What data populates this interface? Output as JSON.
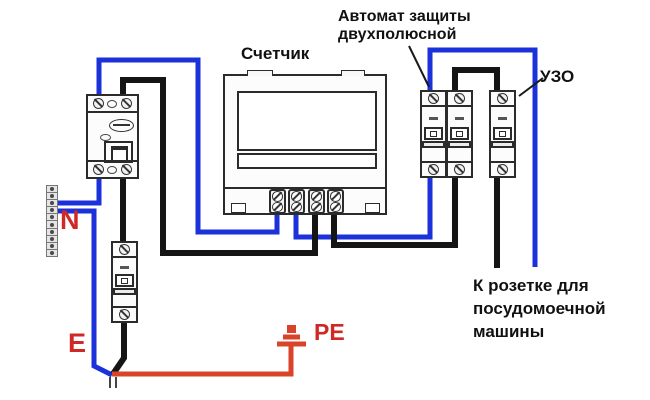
{
  "labels": {
    "meter": "Счетчик",
    "breaker": {
      "line1": "Автомат защиты",
      "line2": "двухполюсной"
    },
    "rcd": "УЗО",
    "neutral": "N",
    "earth": "E",
    "protective_earth": "PE",
    "outlet": {
      "line1": "К розетке для",
      "line2": "посудомоечной",
      "line3": "машины"
    }
  },
  "colors": {
    "neutral_wire_blue": "#1b31d9",
    "phase_wire_black": "#151515",
    "earth_wire_red": "#d8432a",
    "label_red": "#d02824"
  }
}
